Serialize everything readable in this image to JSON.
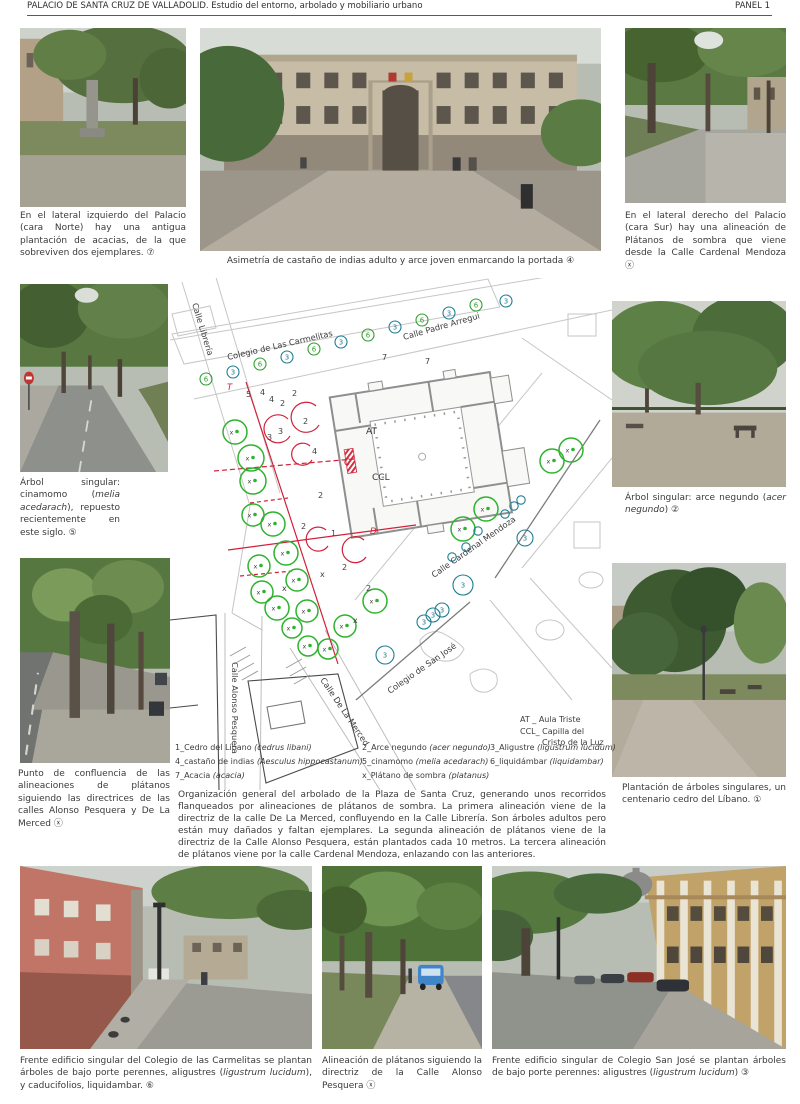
{
  "header": {
    "title": "PALACIO DE SANTA CRUZ DE VALLADOLID. Estudio del entorno, arbolado y mobiliario urbano",
    "panel": "PANEL 1"
  },
  "captions": {
    "acacias": [
      {
        "t": "En el lateral izquierdo del Palacio (cara Norte) hay una antigua plantación de acacias, de la que sobreviven dos ejemplares. ⑦"
      }
    ],
    "portada": [
      {
        "t": "Asimetría de castaño de indias adulto y arce joven enmarcando la portada ④"
      }
    ],
    "platanos_sur": [
      {
        "t": "En el lateral derecho del Palacio (cara Sur) hay una alineación de Plátanos de sombra que viene desde la Calle Cardenal Mendoza ⓧ"
      }
    ],
    "cinamomo": [
      {
        "t": "Árbol singular: cinamomo ("
      },
      {
        "t": "melia acedarach",
        "i": true
      },
      {
        "t": "), repuesto recientemente en este siglo. ⑤"
      }
    ],
    "arce": [
      {
        "t": "Árbol singular: arce negundo ("
      },
      {
        "t": "acer negundo",
        "i": true
      },
      {
        "t": ") ②"
      }
    ],
    "confluencia": [
      {
        "t": "Punto de confluencia de las alineaciones de plátanos siguiendo las directrices de las calles Alonso Pesquera y De La Merced ⓧ"
      }
    ],
    "cedro": [
      {
        "t": "Plantación de árboles singulares, un centenario cedro del Líbano. ①"
      }
    ],
    "carmelitas": [
      {
        "t": "Frente edificio singular del Colegio de las Carmelitas se plantan árboles de bajo porte perennes, aligustres ("
      },
      {
        "t": "ligustrum lucidum",
        "i": true
      },
      {
        "t": "), y caducifolios, liquidambar. ⑥"
      }
    ],
    "pesquera": [
      {
        "t": "Alineación de plátanos siguiendo la directriz de la Calle Alonso Pesquera ⓧ"
      }
    ],
    "sanjose": [
      {
        "t": "Frente edificio singular de Colegio San José se plantan árboles de bajo porte perennes: aligustres ("
      },
      {
        "t": "ligustrum lucidum",
        "i": true
      },
      {
        "t": ") ③"
      }
    ]
  },
  "paragraph": "Organización general del arbolado de la Plaza de Santa Cruz, generando unos recorridos flanqueados por alineaciones de plátanos de sombra. La primera alineación viene de la directriz de la calle De La Merced, confluyendo en la Calle Librería. Son árboles adultos pero están muy dañados y faltan ejemplares. La segunda alineación de plátanos viene de la directriz de la Calle Alonso Pesquera, están plantados cada 10 metros. La tercera alineación de plátanos viene por la calle Cardenal Mendoza, enlazando con las anteriores.",
  "map": {
    "street_labels": [
      {
        "t": "Calle Librería",
        "x": 22,
        "y": 26,
        "r": 73
      },
      {
        "t": "Colegio de Las Carmelitas",
        "x": 58,
        "y": 82,
        "r": -13
      },
      {
        "t": "Calle Padre Arregui",
        "x": 234,
        "y": 62,
        "r": -16
      },
      {
        "t": "Calle Cardenal Mendoza",
        "x": 264,
        "y": 300,
        "r": -35
      },
      {
        "t": "Colegio de San José",
        "x": 220,
        "y": 416,
        "r": -35
      },
      {
        "t": "Calle Alonso Pesquera",
        "x": 62,
        "y": 384,
        "r": 90
      },
      {
        "t": "Calle De La Merced",
        "x": 150,
        "y": 402,
        "r": 56
      }
    ],
    "plan_labels": [
      {
        "t": "AT",
        "x": 196,
        "y": 156
      },
      {
        "t": "CCL",
        "x": 202,
        "y": 202
      }
    ],
    "section_labels": [
      {
        "t": "T",
        "x": 57,
        "y": 112
      },
      {
        "t": "C",
        "x": 174,
        "y": 187
      },
      {
        "t": "D",
        "x": 200,
        "y": 256
      }
    ],
    "key": {
      "line1": "AT _ Aula Triste",
      "line2": "CCL_ Capilla del",
      "line3": "Cristo de la Luz"
    },
    "legend": {
      "col1": [
        {
          "n": "1_Cedro del Líbano ",
          "s": "(cedrus libani)"
        },
        {
          "n": "4_castaño de indias ",
          "s": "(Aesculus hippocastanum)"
        },
        {
          "n": "7_Acacia ",
          "s": "(acacia)"
        }
      ],
      "col2": [
        {
          "n": "2_Arce negundo ",
          "s": "(acer negundo)"
        },
        {
          "n": "5_cinamomo ",
          "s": "(melia acedarach)"
        },
        {
          "n": "x_Plátano de sombra ",
          "s": "(platanus)"
        }
      ],
      "col3": [
        {
          "n": "3_Aligustre ",
          "s": "(ligustrum lucidum)"
        },
        {
          "n": "6_liquidámbar ",
          "s": "(liquidambar)"
        }
      ]
    },
    "platanos": [
      {
        "x": 65,
        "y": 154,
        "r": 12
      },
      {
        "x": 81,
        "y": 180,
        "r": 13
      },
      {
        "x": 83,
        "y": 203,
        "r": 13
      },
      {
        "x": 83,
        "y": 237,
        "r": 11
      },
      {
        "x": 103,
        "y": 246,
        "r": 12
      },
      {
        "x": 116,
        "y": 275,
        "r": 12
      },
      {
        "x": 89,
        "y": 288,
        "r": 11
      },
      {
        "x": 127,
        "y": 302,
        "r": 11
      },
      {
        "x": 92,
        "y": 314,
        "r": 11
      },
      {
        "x": 107,
        "y": 330,
        "r": 12
      },
      {
        "x": 137,
        "y": 333,
        "r": 11
      },
      {
        "x": 122,
        "y": 350,
        "r": 10
      },
      {
        "x": 175,
        "y": 348,
        "r": 11
      },
      {
        "x": 205,
        "y": 323,
        "r": 12
      },
      {
        "x": 138,
        "y": 368,
        "r": 10
      },
      {
        "x": 158,
        "y": 371,
        "r": 10
      },
      {
        "x": 382,
        "y": 183,
        "r": 12
      },
      {
        "x": 401,
        "y": 172,
        "r": 12
      },
      {
        "x": 316,
        "y": 231,
        "r": 12
      },
      {
        "x": 293,
        "y": 251,
        "r": 12
      }
    ],
    "alineacion": [
      {
        "n": "6",
        "x": 36,
        "y": 101
      },
      {
        "n": "3",
        "x": 63,
        "y": 94
      },
      {
        "n": "6",
        "x": 90,
        "y": 86
      },
      {
        "n": "3",
        "x": 117,
        "y": 79
      },
      {
        "n": "6",
        "x": 144,
        "y": 71
      },
      {
        "n": "3",
        "x": 171,
        "y": 64
      },
      {
        "n": "6",
        "x": 198,
        "y": 57
      },
      {
        "n": "3",
        "x": 225,
        "y": 49
      },
      {
        "n": "6",
        "x": 252,
        "y": 42
      },
      {
        "n": "3",
        "x": 279,
        "y": 35
      },
      {
        "n": "6",
        "x": 306,
        "y": 27
      },
      {
        "n": "3",
        "x": 336,
        "y": 23
      }
    ],
    "aligustre_groups": [
      {
        "x": 355,
        "y": 260,
        "r": 8
      },
      {
        "x": 293,
        "y": 307,
        "r": 10
      },
      {
        "x": 254,
        "y": 344,
        "r": 7
      },
      {
        "x": 263,
        "y": 337,
        "r": 7
      },
      {
        "x": 272,
        "y": 332,
        "r": 7
      },
      {
        "x": 215,
        "y": 377,
        "r": 9
      }
    ],
    "aligustre_small": [
      {
        "x": 282,
        "y": 279
      },
      {
        "x": 296,
        "y": 269
      },
      {
        "x": 308,
        "y": 253
      },
      {
        "x": 335,
        "y": 236
      },
      {
        "x": 344,
        "y": 228
      },
      {
        "x": 351,
        "y": 222
      }
    ],
    "numbers": [
      {
        "n": "7",
        "x": 212,
        "y": 82
      },
      {
        "n": "7",
        "x": 255,
        "y": 86
      },
      {
        "n": "5",
        "x": 76,
        "y": 119
      },
      {
        "n": "4",
        "x": 90,
        "y": 117
      },
      {
        "n": "4",
        "x": 99,
        "y": 124
      },
      {
        "n": "2",
        "x": 110,
        "y": 128
      },
      {
        "n": "2",
        "x": 122,
        "y": 118
      },
      {
        "n": "2",
        "x": 133,
        "y": 146
      },
      {
        "n": "3",
        "x": 97,
        "y": 162
      },
      {
        "n": "3",
        "x": 108,
        "y": 156
      },
      {
        "n": "4",
        "x": 142,
        "y": 176
      },
      {
        "n": "2",
        "x": 148,
        "y": 220
      },
      {
        "n": "2",
        "x": 131,
        "y": 251
      },
      {
        "n": "1",
        "x": 161,
        "y": 258
      },
      {
        "n": "2",
        "x": 172,
        "y": 292
      },
      {
        "n": "2",
        "x": 196,
        "y": 313
      },
      {
        "n": "x",
        "x": 112,
        "y": 313
      },
      {
        "n": "x",
        "x": 150,
        "y": 299
      },
      {
        "n": "x",
        "x": 183,
        "y": 345
      }
    ]
  },
  "colors": {
    "green": "#2eb32e",
    "teal": "#1e7d92",
    "red": "#d2203a"
  }
}
